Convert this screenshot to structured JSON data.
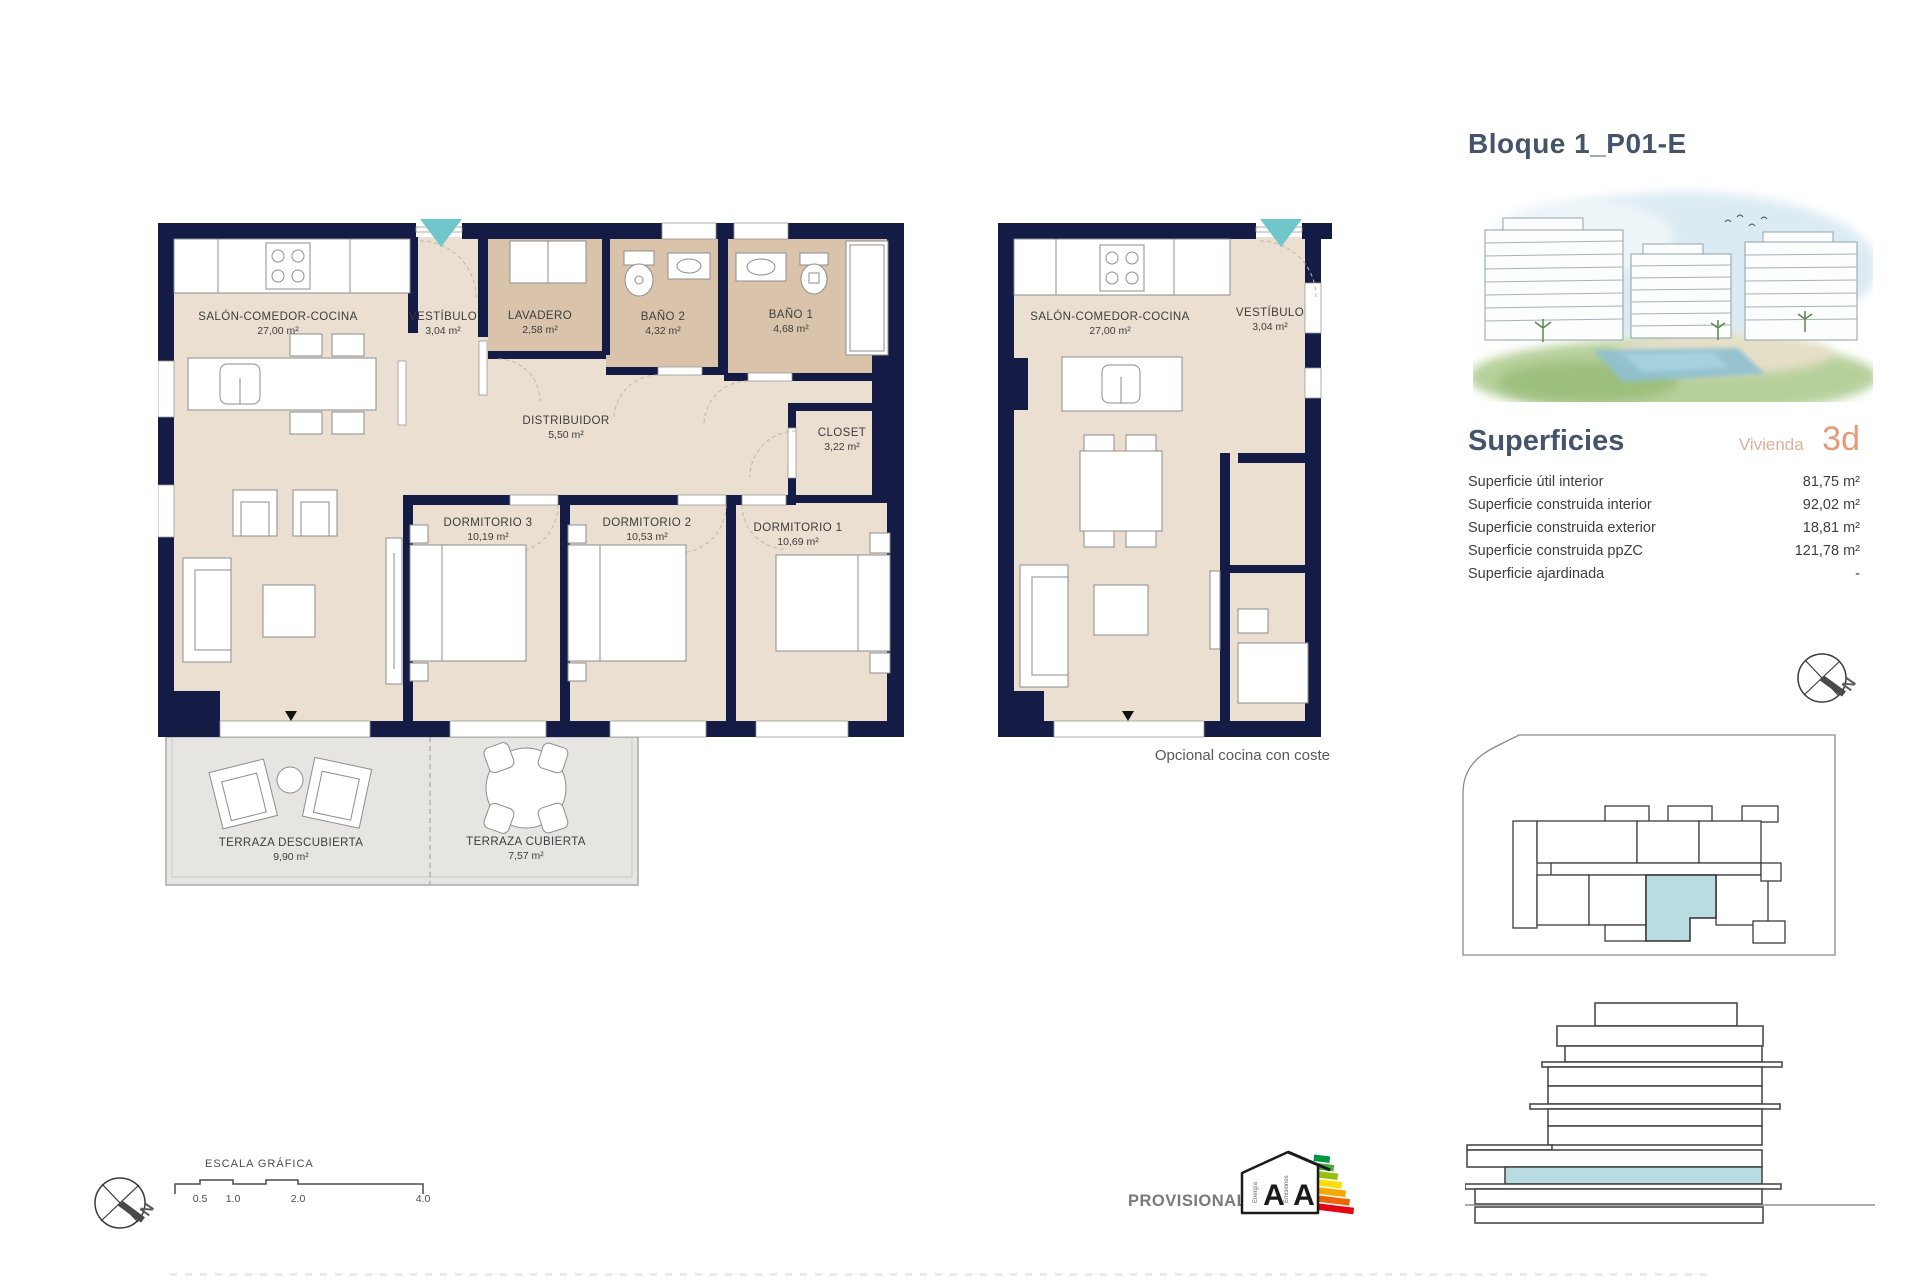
{
  "title": "Bloque 1_P01-E",
  "plan_main": {
    "rooms": [
      {
        "name": "SALÓN-COMEDOR-COCINA",
        "area": "27,00 m²"
      },
      {
        "name": "VESTÍBULO",
        "area": "3,04 m²"
      },
      {
        "name": "LAVADERO",
        "area": "2,58 m²"
      },
      {
        "name": "BAÑO 2",
        "area": "4,32 m²"
      },
      {
        "name": "BAÑO 1",
        "area": "4,68 m²"
      },
      {
        "name": "DISTRIBUIDOR",
        "area": "5,50 m²"
      },
      {
        "name": "CLOSET",
        "area": "3,22 m²"
      },
      {
        "name": "DORMITORIO 3",
        "area": "10,19 m²"
      },
      {
        "name": "DORMITORIO 2",
        "area": "10,53 m²"
      },
      {
        "name": "DORMITORIO 1",
        "area": "10,69 m²"
      },
      {
        "name": "TERRAZA DESCUBIERTA",
        "area": "9,90 m²"
      },
      {
        "name": "TERRAZA CUBIERTA",
        "area": "7,57 m²"
      }
    ]
  },
  "plan_optional": {
    "rooms": [
      {
        "name": "SALÓN-COMEDOR-COCINA",
        "area": "27,00 m²"
      },
      {
        "name": "VESTÍBULO",
        "area": "3,04 m²"
      }
    ],
    "caption": "Opcional cocina con coste"
  },
  "sidebar": {
    "superficies": {
      "heading": "Superficies",
      "vivienda_label": "Vivienda",
      "vivienda_type": "3d",
      "rows": [
        {
          "label": "Superficie útil interior",
          "value": "81,75 m²"
        },
        {
          "label": "Superficie construida interior",
          "value": "92,02 m²"
        },
        {
          "label": "Superficie construida exterior",
          "value": "18,81 m²"
        },
        {
          "label": "Superficie construida ppZC",
          "value": "121,78 m²"
        },
        {
          "label": "Superficie ajardinada",
          "value": "-"
        }
      ]
    }
  },
  "scalebar": {
    "label": "ESCALA GRÁFICA",
    "ticks": [
      "0.5",
      "1.0",
      "2.0",
      "4.0"
    ]
  },
  "provisional": "PROVISIONAL",
  "energy": {
    "letters": [
      "A",
      "A"
    ],
    "words": [
      "Energía",
      "Emisiones"
    ]
  },
  "compass_letter": "N",
  "colors": {
    "wall_navy": "#141b45",
    "floor_beige": "#eadfd1",
    "wet_room_tan": "#d9c4ab",
    "terrace_gray": "#e6e5e2",
    "entry_teal": "#6fc6cb",
    "unit_highlight": "#b9dce2",
    "heading_slate": "#44546a",
    "accent_salmon": "#e59b79"
  }
}
